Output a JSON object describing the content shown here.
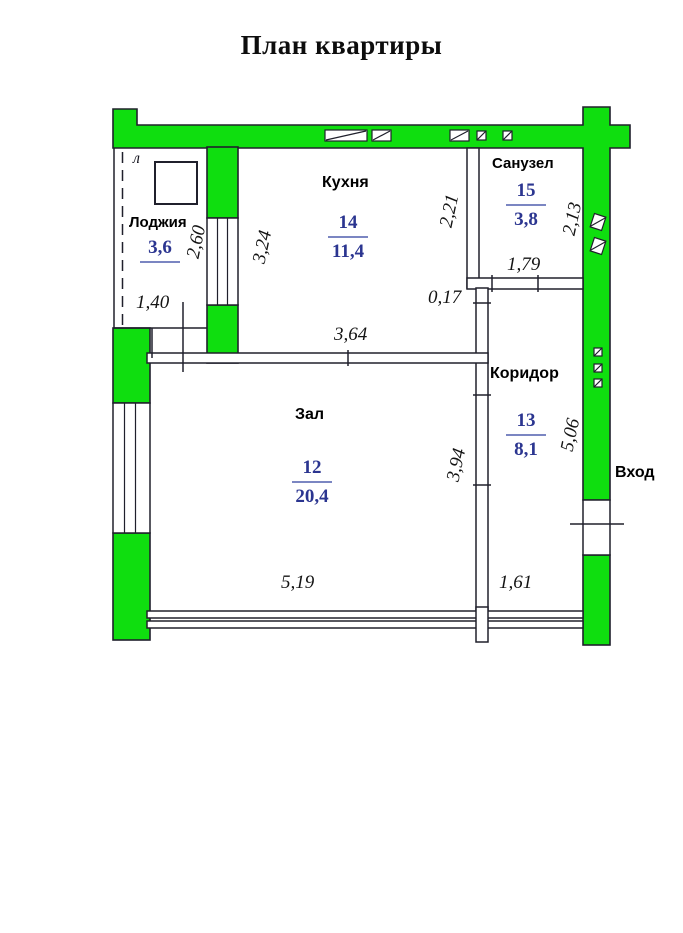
{
  "title": "План квартиры",
  "legend": {
    "loggia_letter": "л",
    "entrance": "Вход"
  },
  "rooms": {
    "loggia": {
      "label": "Лоджия",
      "area": "3,6"
    },
    "kitchen": {
      "label": "Кухня",
      "number": "14",
      "area": "11,4"
    },
    "bathroom": {
      "label": "Санузел",
      "number": "15",
      "area": "3,8"
    },
    "corridor": {
      "label": "Коридор",
      "number": "13",
      "area": "8,1"
    },
    "hall": {
      "label": "Зал",
      "number": "12",
      "area": "20,4"
    }
  },
  "dimensions": {
    "loggia_width": "1,40",
    "loggia_depth": "2,60",
    "kitchen_left": "3,24",
    "kitchen_right": "2,21",
    "kitchen_width": "3,64",
    "wall_offset": "0,17",
    "bathroom_depth": "2,13",
    "bathroom_width": "1,79",
    "hall_depth": "3,94",
    "hall_width": "5,19",
    "corridor_depth": "5,06",
    "corridor_width": "1,61"
  },
  "colors": {
    "wall_fill": "#0FDE0F",
    "outline": "#20202c",
    "room_number": "#2b3590",
    "fraction_line": "#7b86c2"
  }
}
